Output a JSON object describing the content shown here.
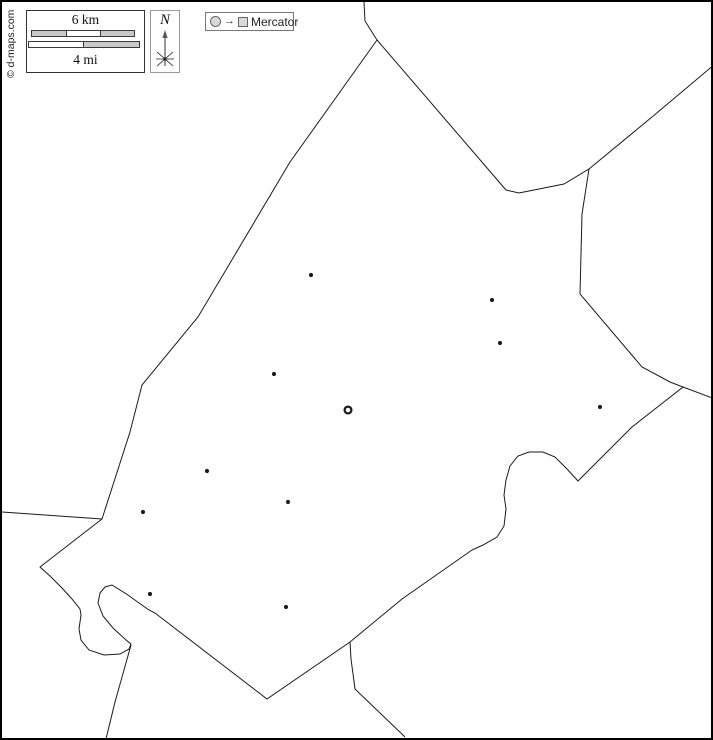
{
  "copyright": "© d-maps.com",
  "scale_bar": {
    "km_label": "6 km",
    "mi_label": "4 mi"
  },
  "compass": {
    "label": "N"
  },
  "legend": {
    "arrow_glyph": "→",
    "projection_label": "Mercator"
  },
  "map": {
    "stroke": "#1a1a1a",
    "land_fill": "#ffffff",
    "marker_color": "#1c1c1c",
    "region_outline": [
      [
        375,
        38
      ],
      [
        504,
        188
      ],
      [
        517,
        191
      ],
      [
        562,
        182
      ],
      [
        587,
        167
      ],
      [
        580,
        212
      ],
      [
        578,
        292
      ],
      [
        640,
        365
      ],
      [
        668,
        380
      ],
      [
        681,
        385
      ],
      [
        630,
        425
      ],
      [
        576,
        479
      ],
      [
        565,
        467
      ],
      [
        553,
        455
      ],
      [
        541,
        450
      ],
      [
        527,
        450
      ],
      [
        516,
        454
      ],
      [
        508,
        464
      ],
      [
        504,
        478
      ],
      [
        502,
        493
      ],
      [
        504,
        507
      ],
      [
        502,
        524
      ],
      [
        495,
        535
      ],
      [
        481,
        543
      ],
      [
        470,
        548
      ],
      [
        430,
        576
      ],
      [
        400,
        597
      ],
      [
        348,
        640
      ],
      [
        265,
        697
      ],
      [
        153,
        611
      ],
      [
        147,
        608
      ],
      [
        137,
        601
      ],
      [
        126,
        593
      ],
      [
        110,
        583
      ],
      [
        103,
        585
      ],
      [
        98,
        591
      ],
      [
        96,
        601
      ],
      [
        101,
        614
      ],
      [
        111,
        626
      ],
      [
        124,
        638
      ],
      [
        129,
        642
      ],
      [
        127,
        647
      ],
      [
        118,
        652
      ],
      [
        102,
        653
      ],
      [
        87,
        648
      ],
      [
        79,
        638
      ],
      [
        77,
        627
      ],
      [
        79,
        613
      ],
      [
        78,
        607
      ],
      [
        70,
        597
      ],
      [
        60,
        586
      ],
      [
        48,
        574
      ],
      [
        38,
        565
      ],
      [
        100,
        517
      ],
      [
        128,
        430
      ],
      [
        140,
        383
      ],
      [
        196,
        315
      ],
      [
        288,
        160
      ]
    ],
    "boundary_lines": [
      {
        "id": "north",
        "points": [
          [
            362,
            0
          ],
          [
            363,
            19
          ],
          [
            375,
            38
          ]
        ]
      },
      {
        "id": "northeast",
        "points": [
          [
            587,
            167
          ],
          [
            650,
            115
          ],
          [
            713,
            62
          ]
        ]
      },
      {
        "id": "east",
        "points": [
          [
            681,
            385
          ],
          [
            713,
            397
          ]
        ]
      },
      {
        "id": "southeast",
        "points": [
          [
            348,
            640
          ],
          [
            349,
            657
          ],
          [
            353,
            687
          ],
          [
            403,
            735
          ]
        ]
      },
      {
        "id": "southwest",
        "points": [
          [
            129,
            643
          ],
          [
            113,
            700
          ],
          [
            104,
            737
          ]
        ]
      },
      {
        "id": "west",
        "points": [
          [
            0,
            510
          ],
          [
            100,
            517
          ]
        ]
      }
    ],
    "cities": [
      {
        "x": 309,
        "y": 273
      },
      {
        "x": 490,
        "y": 298
      },
      {
        "x": 498,
        "y": 341
      },
      {
        "x": 272,
        "y": 372
      },
      {
        "x": 598,
        "y": 405
      },
      {
        "x": 205,
        "y": 469
      },
      {
        "x": 286,
        "y": 500
      },
      {
        "x": 141,
        "y": 510
      },
      {
        "x": 148,
        "y": 592
      },
      {
        "x": 284,
        "y": 605
      }
    ],
    "capital": {
      "x": 346,
      "y": 408
    }
  }
}
